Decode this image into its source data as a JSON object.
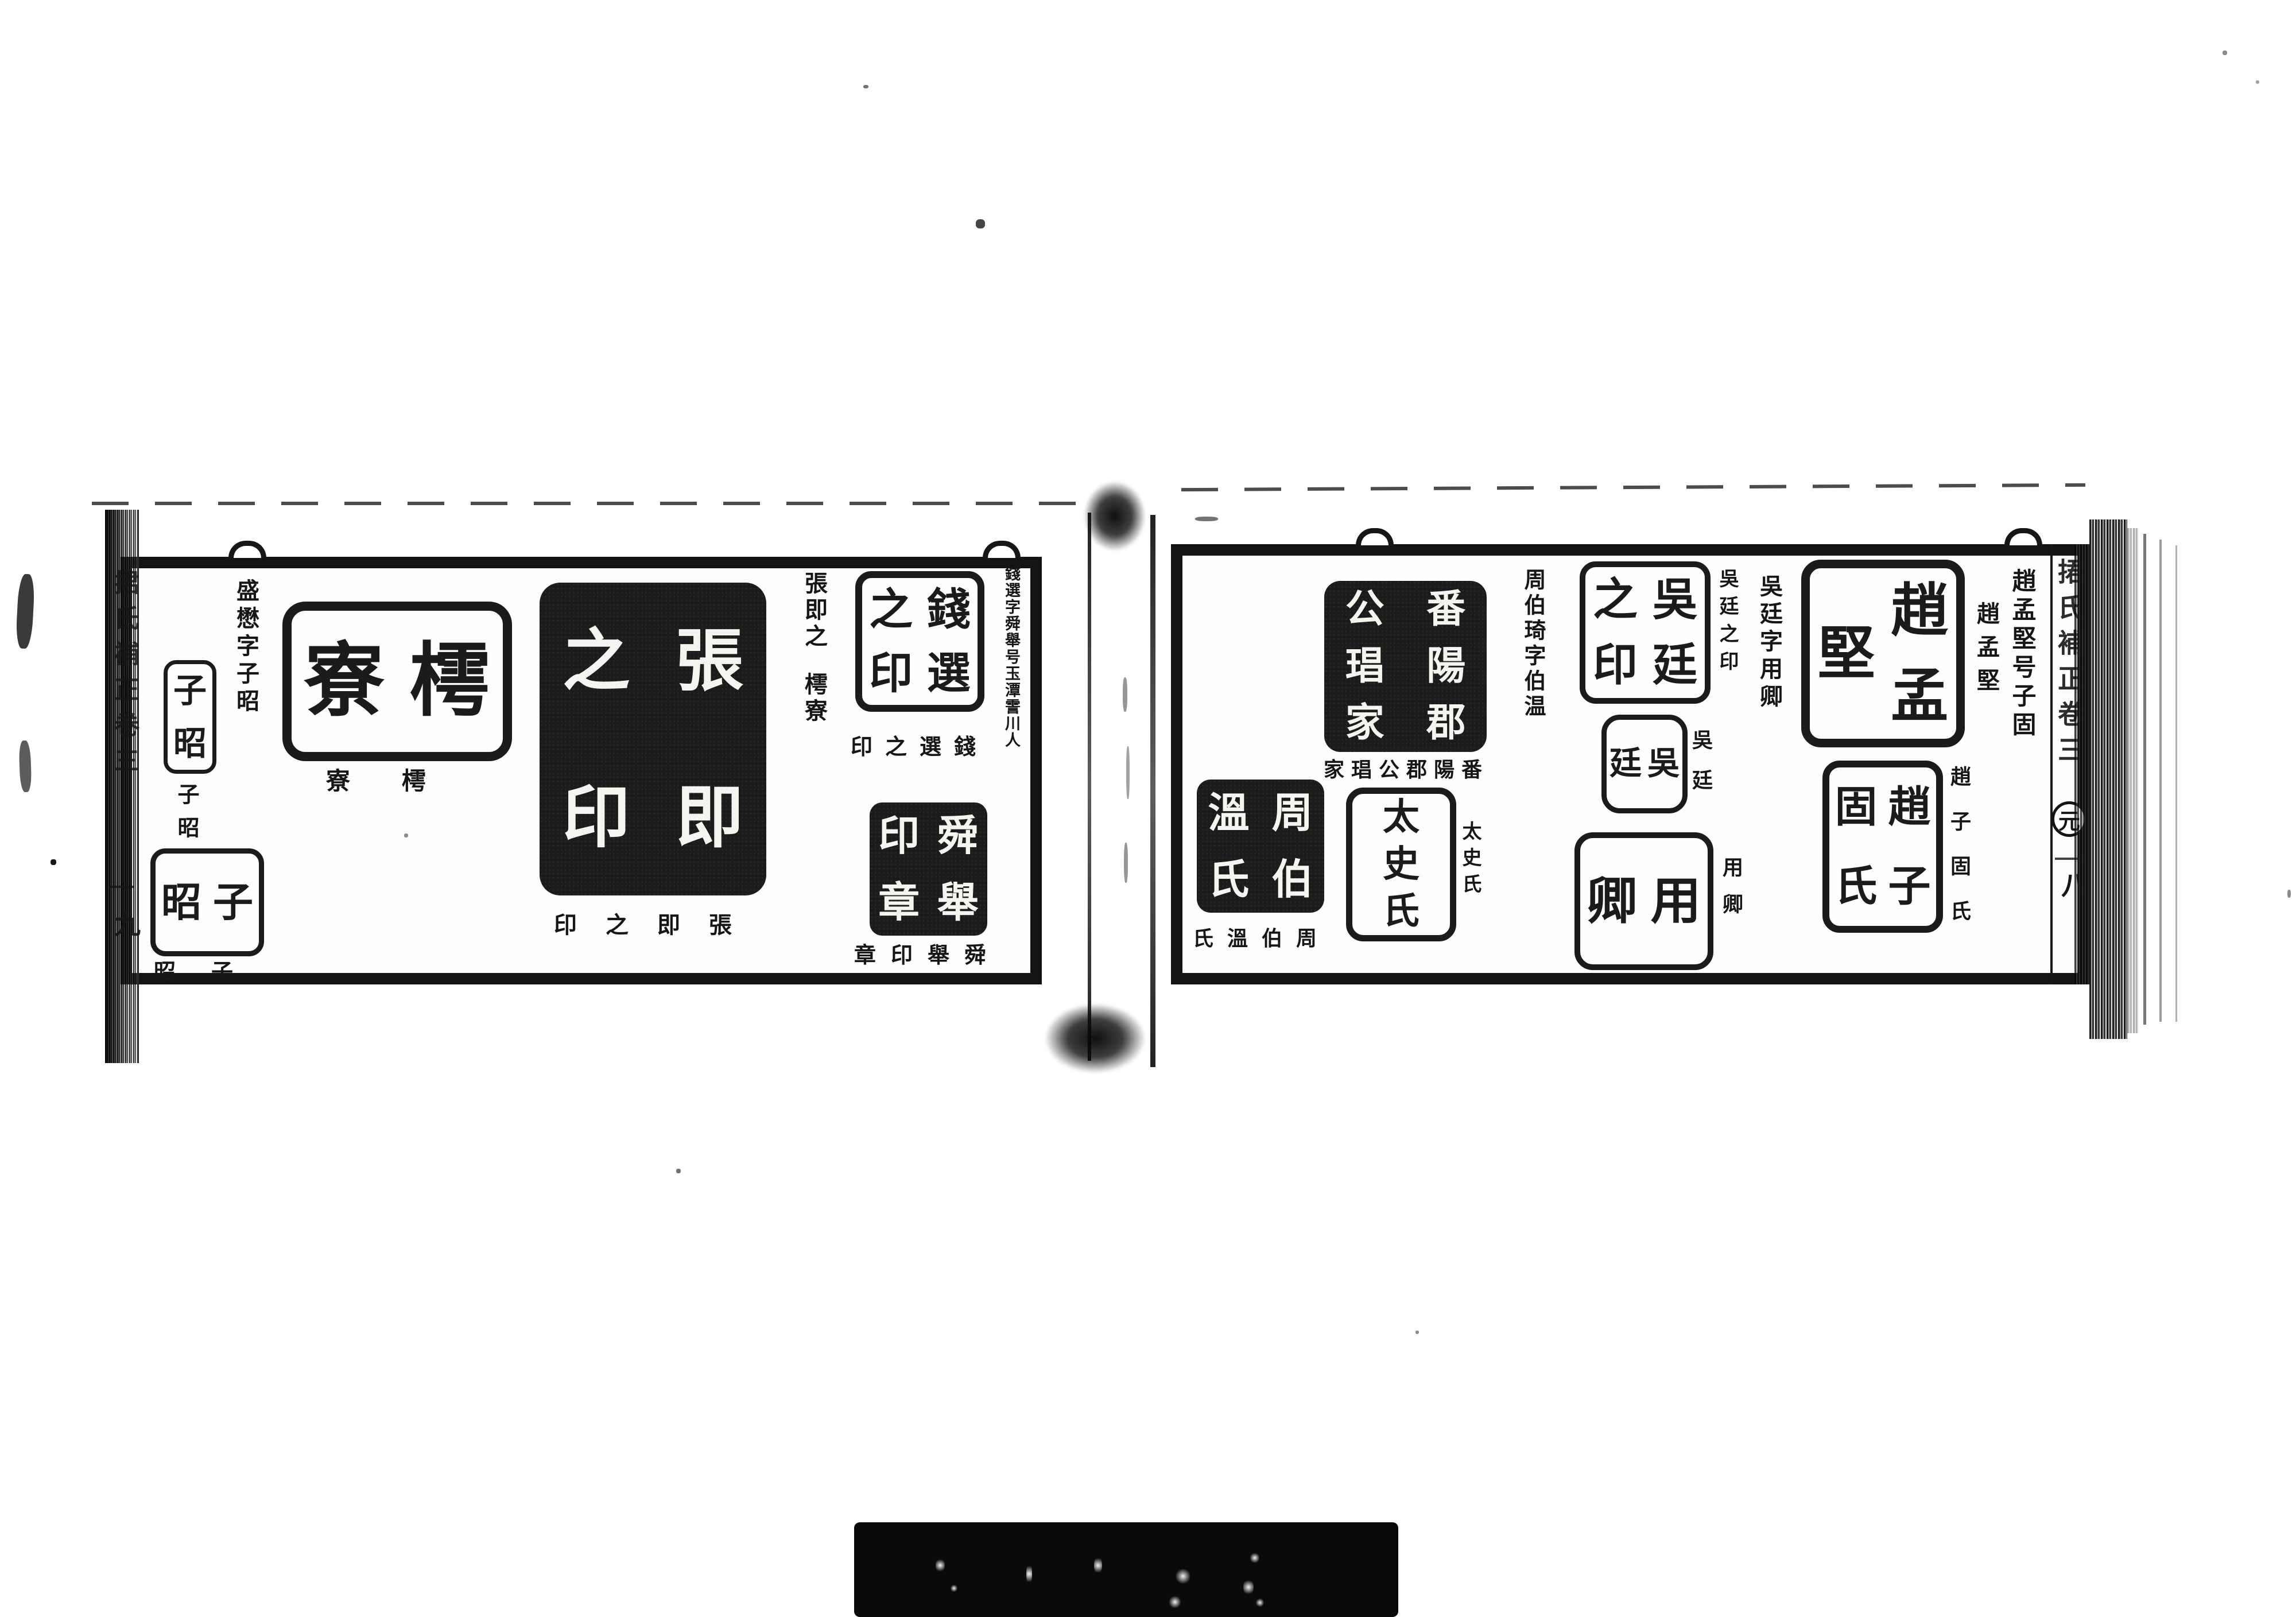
{
  "palette": {
    "ink": "#161616",
    "seal_ink": "#1b1b1b",
    "paper": "#ffffff"
  },
  "left_page": {
    "margin": {
      "running_title": "捃氏補正卷三",
      "page_number": "九"
    },
    "annotations": {
      "qian_xuan_note": "錢選字舜舉号玉潭霅川人",
      "zhang_jizhi_note": "張即之",
      "zhang_jizhi_hao": "樗寮",
      "sheng_mao_note": "盛懋字子昭"
    },
    "seals": [
      {
        "name": "qian-xuan-zhi-yin",
        "face": "錢選之印",
        "cols": 2,
        "style": "outline",
        "caption": "印之選錢"
      },
      {
        "name": "shun-ju-yin-zhang",
        "face": "舜舉印章",
        "cols": 2,
        "style": "solid",
        "caption": "章印舉舜"
      },
      {
        "name": "zhang-jizhi-yin",
        "face": "張即之印",
        "cols": 2,
        "style": "solid",
        "caption": "印之即張"
      },
      {
        "name": "chu-liao",
        "face": "樗寮",
        "cols": 2,
        "style": "outline",
        "caption": "寮樗"
      },
      {
        "name": "zi-zhao-tall",
        "face": "子昭",
        "cols": 1,
        "style": "outline",
        "caption": "子昭"
      },
      {
        "name": "zi-zhao-square",
        "face": "子昭",
        "cols": 2,
        "style": "outline",
        "caption": "昭子"
      }
    ]
  },
  "right_page": {
    "margin": {
      "running_title": "捃氏補正卷三",
      "dynasty_marker": "元",
      "page_number": "八"
    },
    "annotations": {
      "zhao_mengjian_note": "趙孟堅号子固",
      "wu_ting_note": "吳廷字用卿",
      "zhou_boqi_note": "周伯琦字伯温"
    },
    "seals": [
      {
        "name": "zhao-mengjian",
        "face": "趙孟堅",
        "cols": 2,
        "style": "outline",
        "caption": "趙孟堅"
      },
      {
        "name": "zhao-zigu-shi",
        "face": "趙子固氏",
        "cols": 2,
        "style": "outline",
        "caption": "趙子固氏"
      },
      {
        "name": "wu-ting-zhi-yin",
        "face": "吳廷之印",
        "cols": 2,
        "style": "outline",
        "caption": "吳廷之印"
      },
      {
        "name": "wu-ting",
        "face": "吳廷",
        "cols": 2,
        "style": "outline",
        "caption": "吳廷"
      },
      {
        "name": "yong-qing",
        "face": "用卿",
        "cols": 2,
        "style": "outline",
        "caption": "用卿"
      },
      {
        "name": "fanyang-jungong-jia",
        "face": "番陽郡公琩家",
        "cols": 2,
        "style": "solid",
        "caption": "家琩公郡陽番"
      },
      {
        "name": "tai-shi-shi",
        "face": "太史氏",
        "cols": 1,
        "style": "outline",
        "caption": "太史氏"
      },
      {
        "name": "zhou-bowen-shi",
        "face": "周伯溫氏",
        "cols": 2,
        "style": "solid",
        "caption": "氏溫伯周"
      }
    ]
  }
}
